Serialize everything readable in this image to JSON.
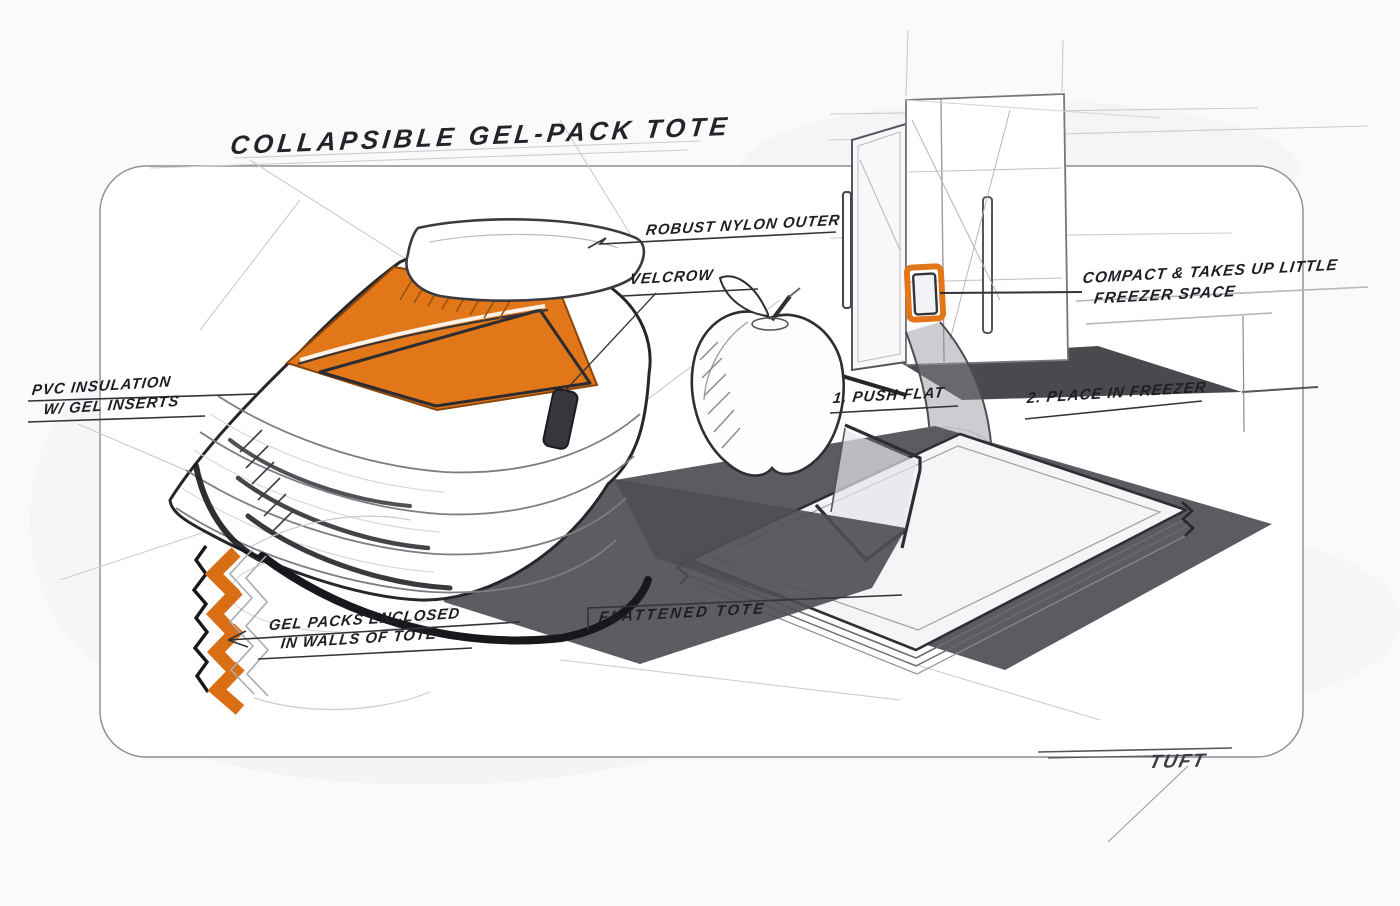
{
  "title": {
    "text": "COLLAPSIBLE GEL-PACK TOTE"
  },
  "annotations": {
    "robust_nylon": "ROBUST NYLON OUTER",
    "velcro": "VELCROW",
    "insulation_line1": "PVC INSULATION",
    "insulation_line2": "W/ GEL INSERTS",
    "gel_packs_line1": "GEL PACKS ENCLOSED",
    "gel_packs_line2": "IN WALLS OF TOTE",
    "step1": "1. PUSH FLAT",
    "step2": "2. PLACE IN FREEZER",
    "compact_line1": "COMPACT & TAKES UP LITTLE",
    "compact_line2": "FREEZER SPACE",
    "flattened": "FLATTENED TOTE",
    "signature": "TUFT"
  },
  "sketch_objects": {
    "main": "collapsible bellows tote with open lid and orange interior",
    "detail": "cross-section chevrons showing gel packs in walls",
    "scene1": "apple beside tote",
    "scene2": "flattened tote on floor mat",
    "scene3": "open freezer with flattened tote stored inside, motion arrow"
  },
  "colors": {
    "accent_orange": "#E2771A",
    "chevron_orange": "#D96E15",
    "sketch_ink": "#26262B",
    "shadow_gray": "#55555B",
    "card_border": "#8C8C92",
    "background": "#FAFAFB"
  }
}
